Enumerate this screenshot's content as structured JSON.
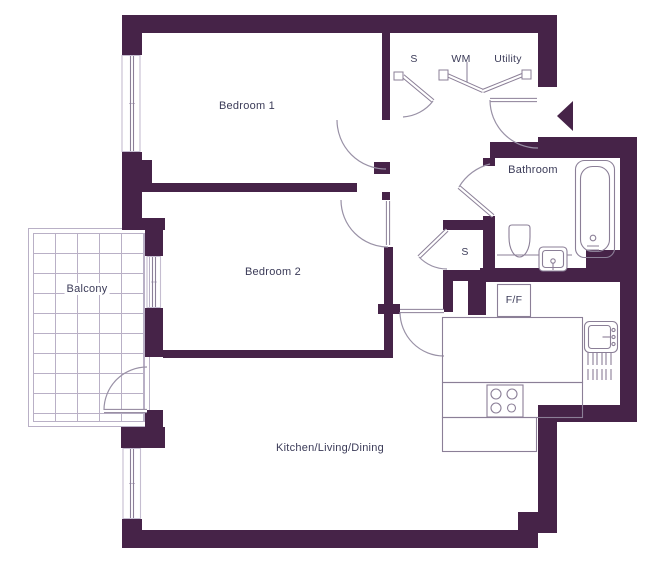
{
  "plan": {
    "title": "Apartment floor plan",
    "labels": {
      "bedroom1": "Bedroom 1",
      "bedroom2": "Bedroom 2",
      "balcony": "Balcony",
      "bathroom": "Bathroom",
      "kitchen": "Kitchen/Living/Dining",
      "store_top": "S",
      "washing_machine": "WM",
      "utility": "Utility",
      "store_hall": "S",
      "fridge_freezer": "F/F"
    },
    "colors": {
      "wall": "#462348",
      "text": "#3b3b58",
      "fixture_line": "#8b7f97",
      "arc_line": "#9991a6",
      "light_line": "#c5bdd0",
      "balcony_grid": "#b9b0c6",
      "background": "#ffffff"
    },
    "icons": {
      "entry_arrow": "entry-arrow"
    }
  }
}
